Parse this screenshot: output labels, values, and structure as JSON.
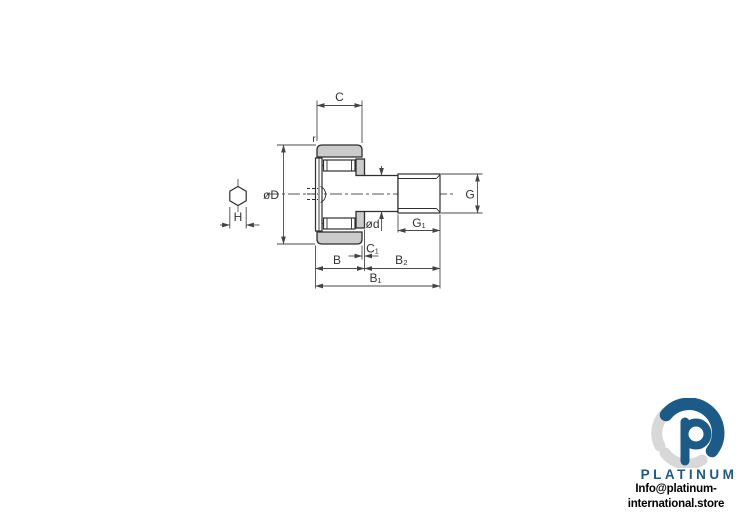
{
  "drawing": {
    "labels": {
      "c": "C",
      "r": "r",
      "od": "øD",
      "h": "H",
      "id": "ød",
      "g": "G",
      "g1": "G₁",
      "c1": "C₁",
      "b": "B",
      "b2": "B₂",
      "b1": "B₁"
    },
    "colors": {
      "part_fill": "#cbcbcb",
      "part_line": "#2e2e2e",
      "dim_line": "#4a4a4a",
      "text": "#333333",
      "background": "#ffffff"
    }
  },
  "branding": {
    "name": "PLATINUM",
    "email": "Info@platinum-international.store",
    "logo_blue": "#1c5a87",
    "logo_gray": "#d8d8d8"
  }
}
